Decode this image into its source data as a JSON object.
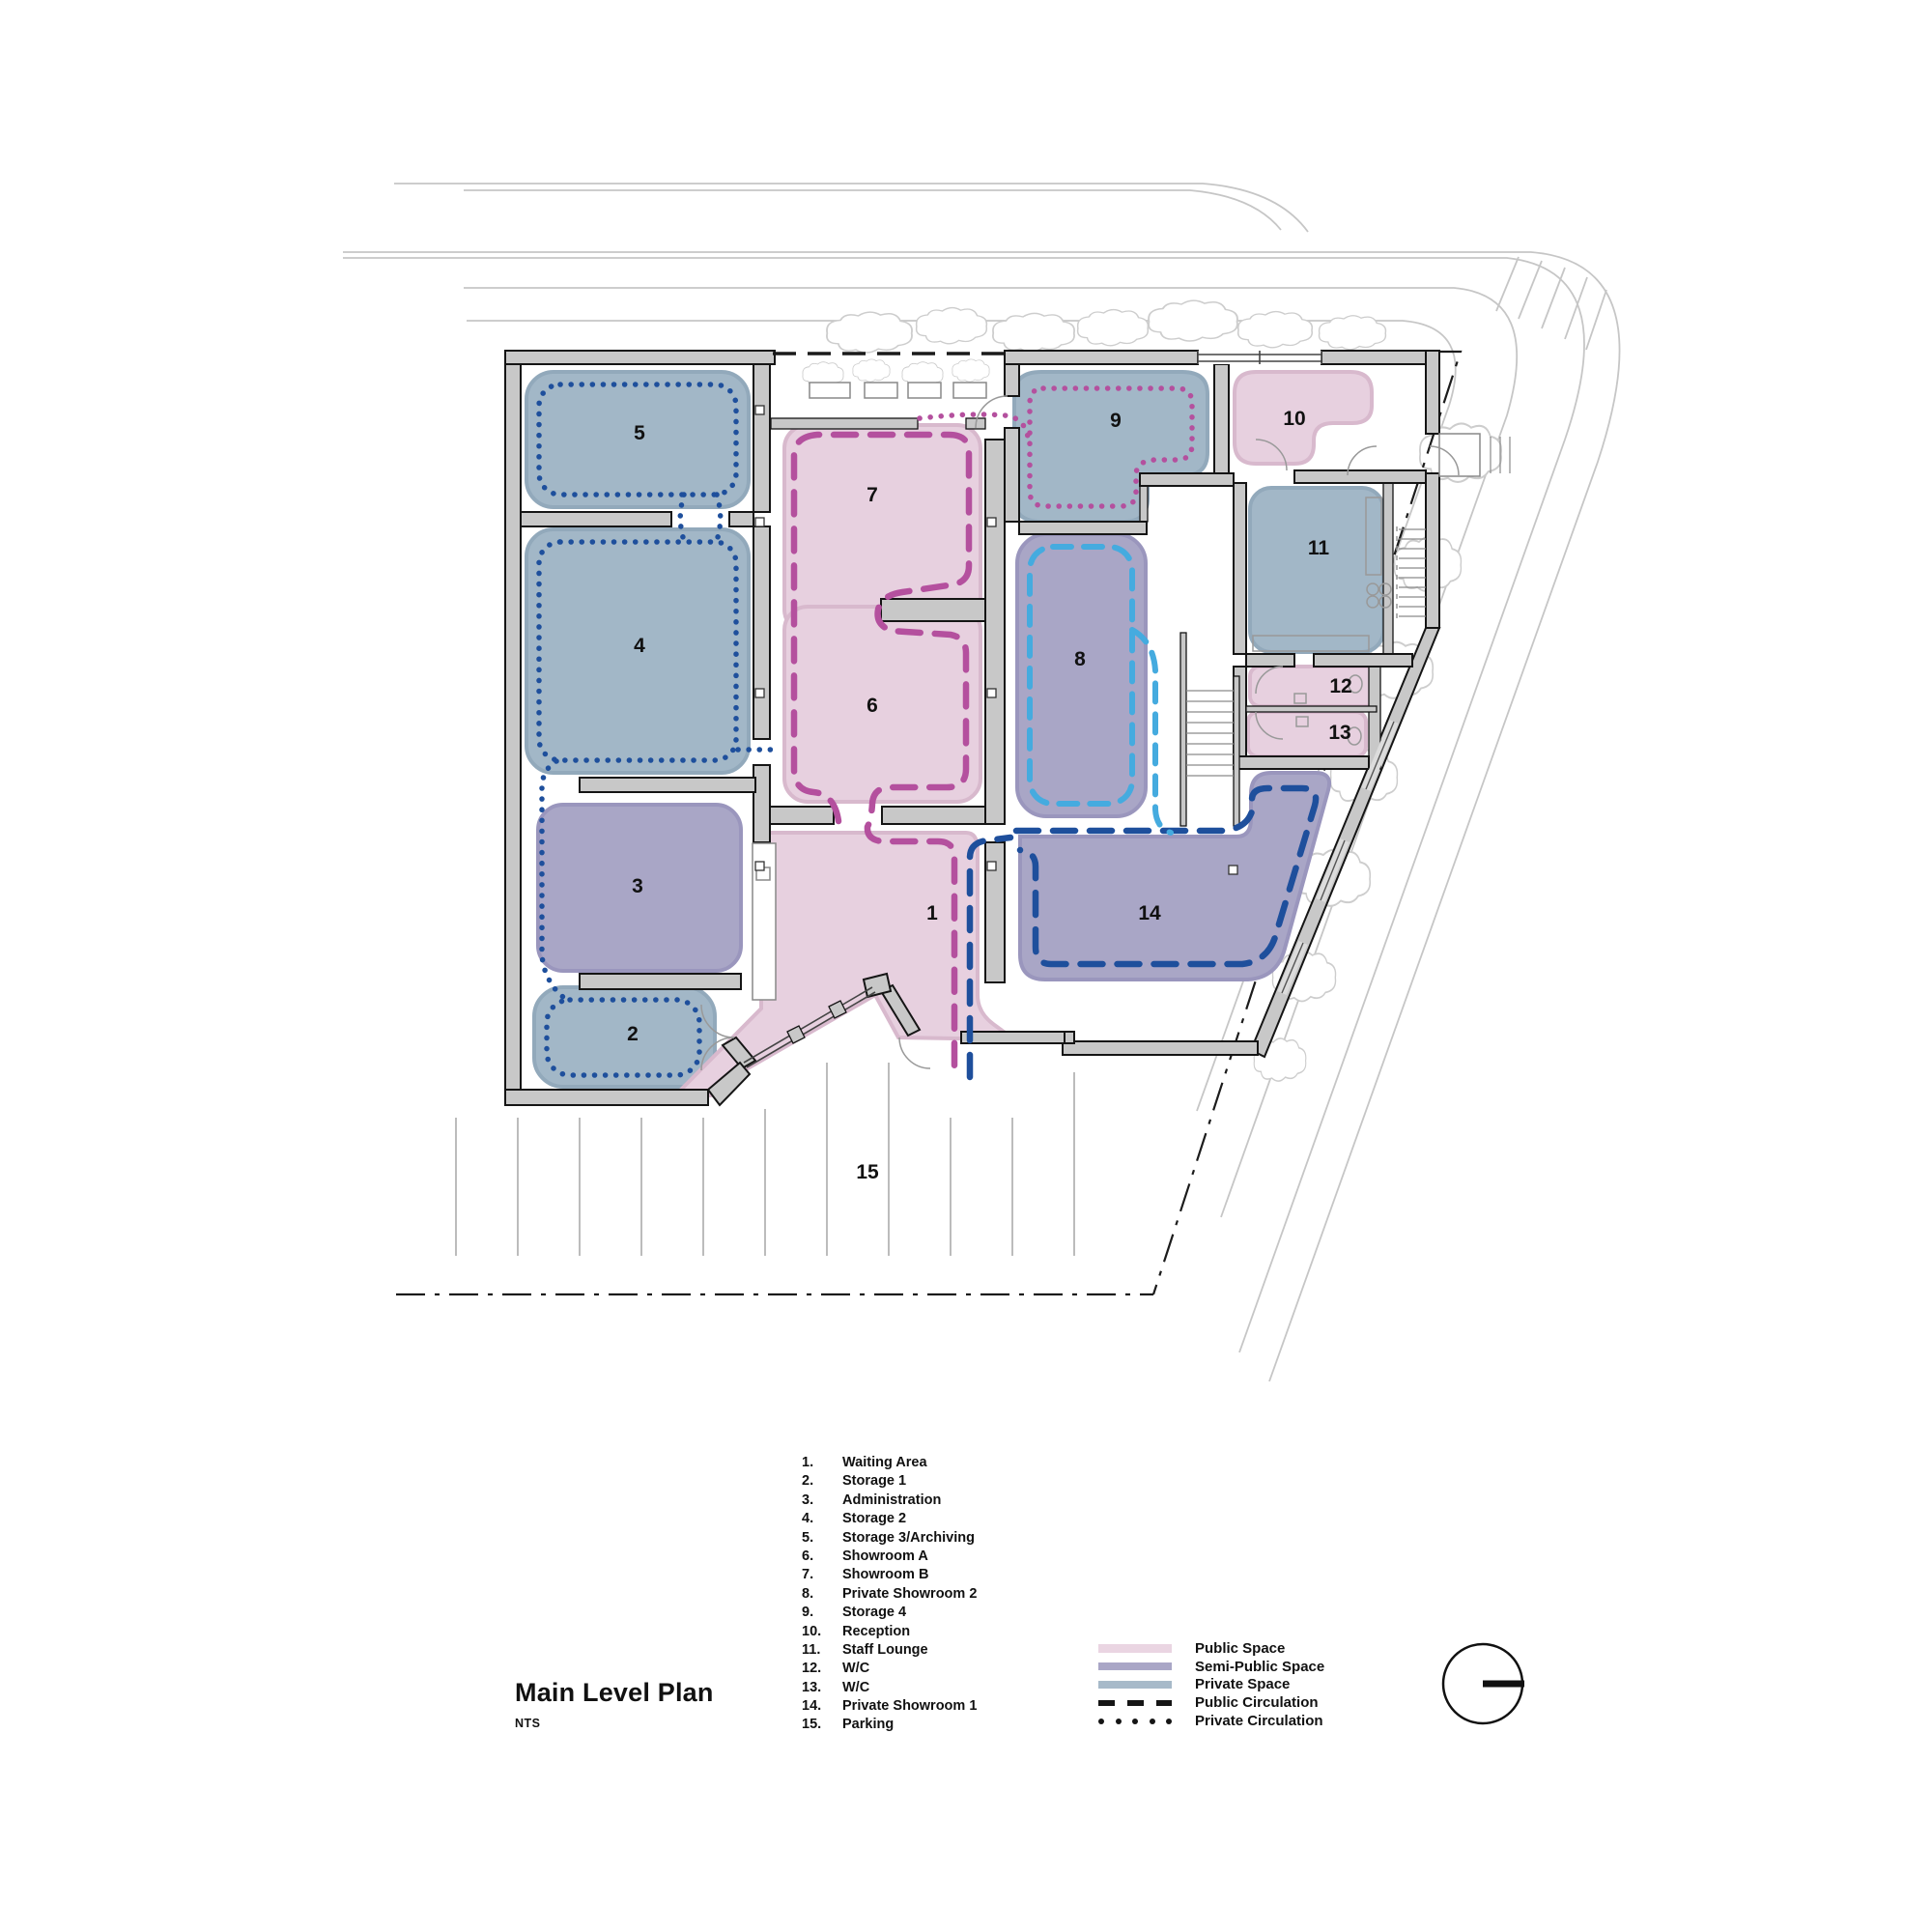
{
  "title": {
    "text": "Main Level Plan",
    "scale": "NTS"
  },
  "rooms": [
    {
      "num": "1.",
      "label": "Waiting Area",
      "plan": "1",
      "category": "public"
    },
    {
      "num": "2.",
      "label": "Storage 1",
      "plan": "2",
      "category": "private"
    },
    {
      "num": "3.",
      "label": "Administration",
      "plan": "3",
      "category": "semi_public"
    },
    {
      "num": "4.",
      "label": "Storage 2",
      "plan": "4",
      "category": "private"
    },
    {
      "num": "5.",
      "label": "Storage 3/Archiving",
      "plan": "5",
      "category": "private"
    },
    {
      "num": "6.",
      "label": "Showroom A",
      "plan": "6",
      "category": "public"
    },
    {
      "num": "7.",
      "label": "Showroom B",
      "plan": "7",
      "category": "public"
    },
    {
      "num": "8.",
      "label": "Private Showroom 2",
      "plan": "8",
      "category": "semi_public"
    },
    {
      "num": "9.",
      "label": "Storage 4",
      "plan": "9",
      "category": "private"
    },
    {
      "num": "10.",
      "label": "Reception",
      "plan": "10",
      "category": "public"
    },
    {
      "num": "11.",
      "label": "Staff Lounge",
      "plan": "11",
      "category": "private"
    },
    {
      "num": "12.",
      "label": "W/C",
      "plan": "12",
      "category": "public"
    },
    {
      "num": "13.",
      "label": "W/C",
      "plan": "13",
      "category": "public"
    },
    {
      "num": "14.",
      "label": "Private Showroom 1",
      "plan": "14",
      "category": "semi_public"
    },
    {
      "num": "15.",
      "label": "Parking",
      "plan": "15",
      "category": "none"
    }
  ],
  "legend": [
    {
      "sample": "swatch-public",
      "label": "Public Space",
      "color": "#ead5e2"
    },
    {
      "sample": "swatch-semi-public",
      "label": "Semi-Public Space",
      "color": "#a9a6c6"
    },
    {
      "sample": "swatch-private",
      "label": "Private Space",
      "color": "#a7bac9"
    },
    {
      "sample": "dashed-line",
      "label": "Public Circulation",
      "color": "#151515"
    },
    {
      "sample": "dotted-line",
      "label": "Private Circulation",
      "color": "#151515"
    }
  ],
  "colors": {
    "public_space": "#e7d0df",
    "semi_public_space": "#a9a6c6",
    "private_space": "#a2b7c7",
    "wall_fill": "#c8c8c8",
    "wall_line": "#151515",
    "circulation_magenta": "#b4509e",
    "circulation_dark_blue": "#1e4f9c",
    "circulation_cyan": "#45abdf",
    "site_line": "#c6c6c6",
    "parking_stripe": "#bcbcbc"
  }
}
